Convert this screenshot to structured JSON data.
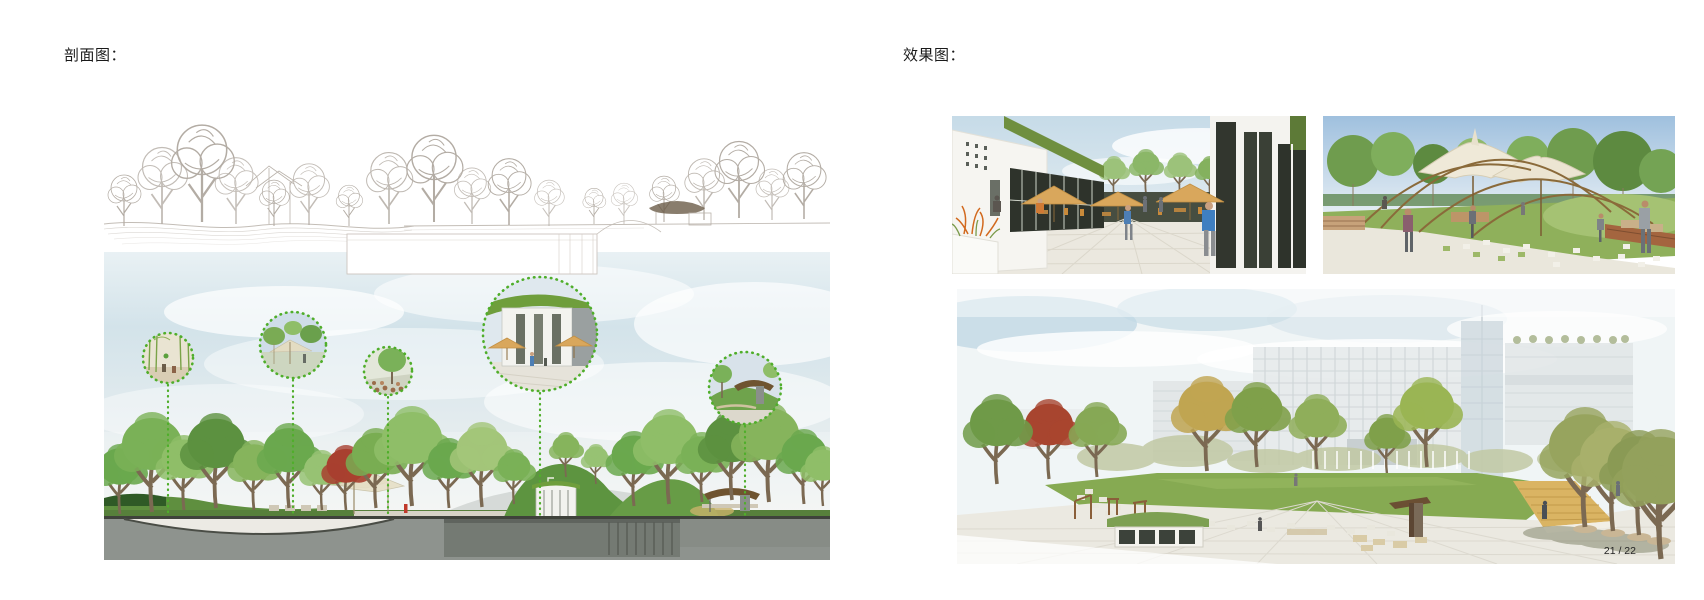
{
  "labels": {
    "left_section": "剖面图：",
    "right_section": "效果图："
  },
  "pagination": {
    "text": "21 / 22"
  },
  "figures": {
    "section_lineart": {
      "description": "line-art landscape section: sketched trees, undulating terrain, below-grade building outline, pavilion roof"
    },
    "section_colored": {
      "description": "rendered landscape section: sky, tree rows, green roof berms, underground building, five dotted detail callouts",
      "callouts": [
        "bamboo courtyard interior",
        "canopy walk among trees",
        "feature tree with stone edging",
        "sunken courtyard with umbrellas",
        "hillside pavilion"
      ]
    },
    "render_courtyard": {
      "description": "courtyard rendering with tan umbrellas, green sloped roof, glazing and pedestrians"
    },
    "render_canopy_plaza": {
      "description": "park plaza rendering with tensile fabric canopy on curved arcs, lawn and checker paving"
    },
    "render_campus_lawn": {
      "description": "campus rendering: white buildings, central lawn, timber ramp, tree-lined plaza"
    }
  },
  "colors": {
    "text": "#1a1a1a",
    "callout_green": "#4fae2a",
    "umbrella_tan": "#d9a75c",
    "sky_blue": "#cfe0e9",
    "grass_green": "#6aa84e",
    "earth_gray": "#8e938e",
    "roof_green": "#6f8f3f"
  }
}
